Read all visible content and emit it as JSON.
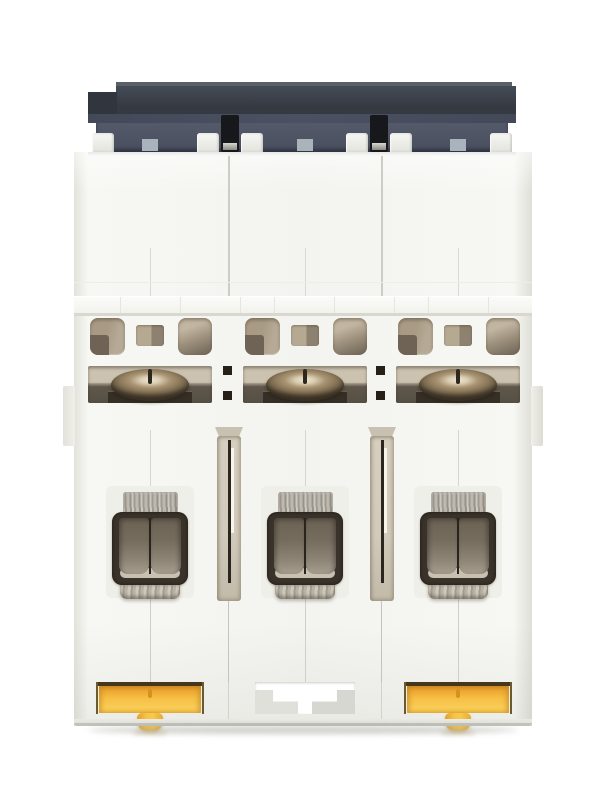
{
  "image": {
    "type": "product-photo",
    "subject": "3-pole DIN-rail miniature circuit breaker, rear/bottom view",
    "background": "#ffffff",
    "width": 600,
    "height": 800
  },
  "device": {
    "layout": {
      "bodyLeft": 74,
      "bodyTop": 152,
      "bodyWidth": 458,
      "bodyBottom": 726,
      "capLeft": 88,
      "capTop": 82,
      "capWidth": 428,
      "poleLefts": [
        74,
        229,
        382
      ],
      "poleCenters": [
        150,
        305,
        458
      ],
      "dividers": [
        229,
        382
      ],
      "tabXs": [
        92,
        197,
        241,
        346,
        390,
        490
      ],
      "ledgeSeamXs": [
        120,
        180,
        240,
        274,
        334,
        394,
        428,
        488
      ]
    },
    "poles": [
      {
        "label": "pole-1",
        "bottom_fitting": "yellow-din-clip"
      },
      {
        "label": "pole-2",
        "bottom_fitting": "center-recess"
      },
      {
        "label": "pole-3",
        "bottom_fitting": "yellow-din-clip"
      }
    ],
    "palette": {
      "background": "#ffffff",
      "capTopEdge": "#5a606a",
      "capSlabHi": "#464c56",
      "capSlabLo": "#343942",
      "capSlabLeft": "#31353d",
      "capLayer2": "#434959",
      "capLayer3Hi": "#545a6a",
      "capLayer3Lo": "#484e5e",
      "tabHi": "#f6f6f3",
      "tabLo": "#e4e4de",
      "vent": "#a9b3bc",
      "pin": "#17181c",
      "pinGlintHi": "#d8d8d0",
      "pinGlintLo": "#8a8a82",
      "bodyBase": "#f3f3ef",
      "bodyEdge": "#e2e2db",
      "seam": "#cdcdc6",
      "seamLight": "#dadad4",
      "ledgeHi": "#fbfbf9",
      "ledgeLo": "#f1f1eb",
      "ledgeShadow": "#d8d8d1",
      "cutTan": "#a89a84",
      "cutDark": "#6e6355",
      "cutLight": "#c2b6a2",
      "cutMid": "#8d8170",
      "slotHi": "#ccc2b0",
      "slotLo": "#564f44",
      "domeHi": "#f0e7d3",
      "domeMid": "#937f60",
      "domeLo": "#453c2e",
      "screwSlit": "#2c2820",
      "plate": "#362f26",
      "squareHole": "#262018",
      "metalTabHi": "#ccc8bf",
      "metalTabLo": "#a19c92",
      "frame": "#3a332b",
      "panelTop": "#6b6254",
      "panelBottom": "#a69d8f",
      "panelSplit": "#29241d",
      "clampHi": "#c8c0b1",
      "clampMetal": "#a29d91",
      "channelTan": "#d2caba",
      "channelDark": "#2b2620",
      "channelHi": "#f7f4ec",
      "clipOutline": "#46371c",
      "clipDeep": "#d98f24",
      "clipYellow": "#f6bf44",
      "clipLight": "#f9cc55",
      "clipMark": "#d59222",
      "recessBlockA": "#e0e0da",
      "recessBlockB": "#d7d7d1",
      "bottomLine": "#c2c2bb",
      "dropShadow": "rgba(160,160,152,0.5)"
    }
  }
}
